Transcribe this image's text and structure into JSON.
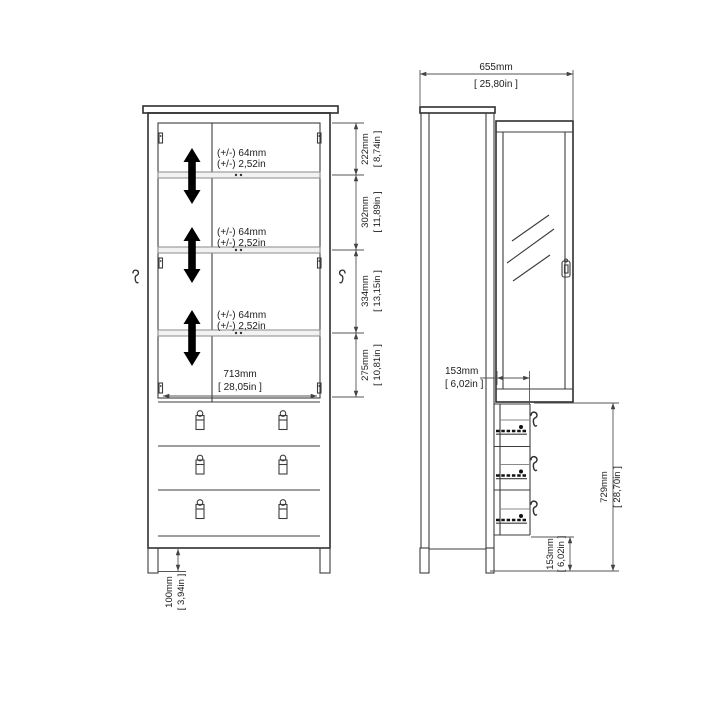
{
  "page": {
    "background": "#ffffff",
    "description": "Technical dimension drawing of a display cabinet with two doors, adjustable shelves and three drawers (front view and side view)"
  },
  "front_view": {
    "adjustable_shelves": [
      {
        "tolerance_mm": "(+/-) 64mm",
        "tolerance_in": "(+/-) 2,52in"
      },
      {
        "tolerance_mm": "(+/-) 64mm",
        "tolerance_in": "(+/-) 2,52in"
      },
      {
        "tolerance_mm": "(+/-) 64mm",
        "tolerance_in": "(+/-) 2,52in"
      }
    ],
    "inner_width": {
      "mm": "713mm",
      "in": "[ 28,05in ]"
    },
    "height_segments": [
      {
        "mm": "222mm",
        "in": "[ 8,74in ]"
      },
      {
        "mm": "302mm",
        "in": "[ 11,89in ]"
      },
      {
        "mm": "334mm",
        "in": "[ 13,15in ]"
      },
      {
        "mm": "275mm",
        "in": "[ 10,81in ]"
      }
    ],
    "leg_height": {
      "mm": "100mm",
      "in": "[ 3,94in ]"
    }
  },
  "side_view": {
    "total_depth": {
      "mm": "655mm",
      "in": "[ 25,80in ]"
    },
    "drawer_open_depth": {
      "mm": "153mm",
      "in": "[ 6,02in ]"
    },
    "drawer_section_height": {
      "mm": "729mm",
      "in": "[ 28,70in ]"
    },
    "bottom_clearance": {
      "mm": "153mm",
      "in": "[ 6,02in ]"
    }
  },
  "icons": {
    "shelf_adjust_arrow": "double-vertical-arrow",
    "drawer_handle_hook": "hook",
    "door_glass": "diagonal-hatch"
  },
  "colors": {
    "line": "#3c3c3c",
    "dimension_line": "#555555",
    "arrow_fill": "#000000",
    "background": "#ffffff"
  }
}
